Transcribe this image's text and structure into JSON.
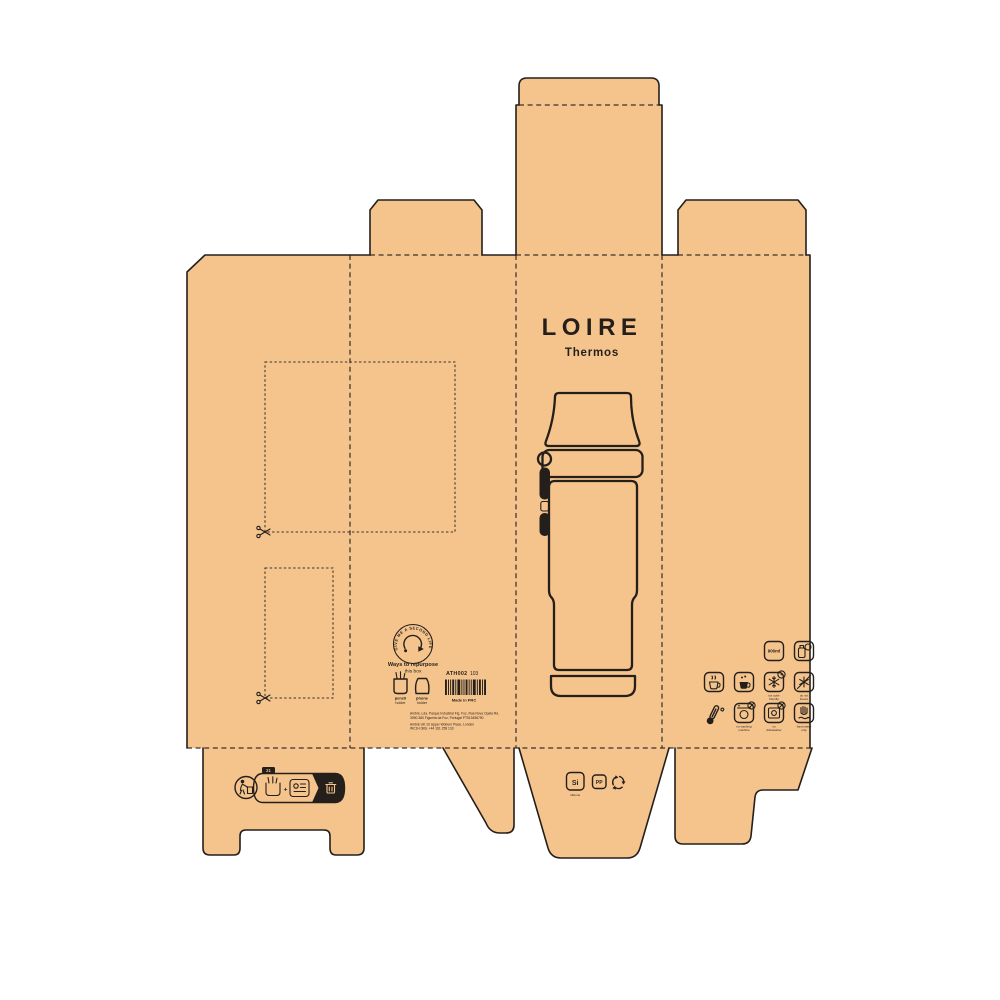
{
  "colors": {
    "cardboard": "#F5C48C",
    "line": "#241f1b",
    "background": "#ffffff"
  },
  "front_panel": {
    "title": "LOIRE",
    "subtitle": "Thermos"
  },
  "info_panel": {
    "second_life_badge": "GIVE ME A SECOND LIFE",
    "repurpose_title": "Ways to repurpose",
    "repurpose_subtitle": "this box",
    "use_1_line1": "pencil",
    "use_1_line2": "holder",
    "use_2_line1": "phone",
    "use_2_line2": "holder",
    "sku": "ATH002",
    "sku_suffix": "103",
    "barcode_pattern": "2112131121131212",
    "made_in": "Made in PRC",
    "address_line1": "Ambré, Lda. Parque Industrial Fig. Foz, Rua Nova Opata Rd,",
    "address_line2": "3090-380 Figueira da Foz, Portugal PT513456790",
    "address_line3": "Ambré UK 10 Upper Woburn Place, London",
    "address_line4": "WC1H 0BS, +44 161 258 133"
  },
  "icon_panel": {
    "capacity": "900ml",
    "badge_plus": "+",
    "freeze_caption_line1": "ice cube",
    "freeze_caption_line2": "friendly",
    "no_freeze_caption_line1": "do not",
    "no_freeze_caption_line2": "freeze",
    "no_washer_caption_line1": "no washing",
    "no_washer_caption_line2": "machine",
    "no_dishwasher_caption_line1": "no",
    "no_dishwasher_caption_line2": "dishwasher",
    "hand_wash_caption_line1": "hand wash",
    "hand_wash_caption_line2": "only"
  },
  "recycling_banner": {
    "code": "21",
    "plus": "+"
  },
  "materials": {
    "silicone_symbol": "Si",
    "silicone_caption": "silicone",
    "pp_symbol": "PP"
  }
}
